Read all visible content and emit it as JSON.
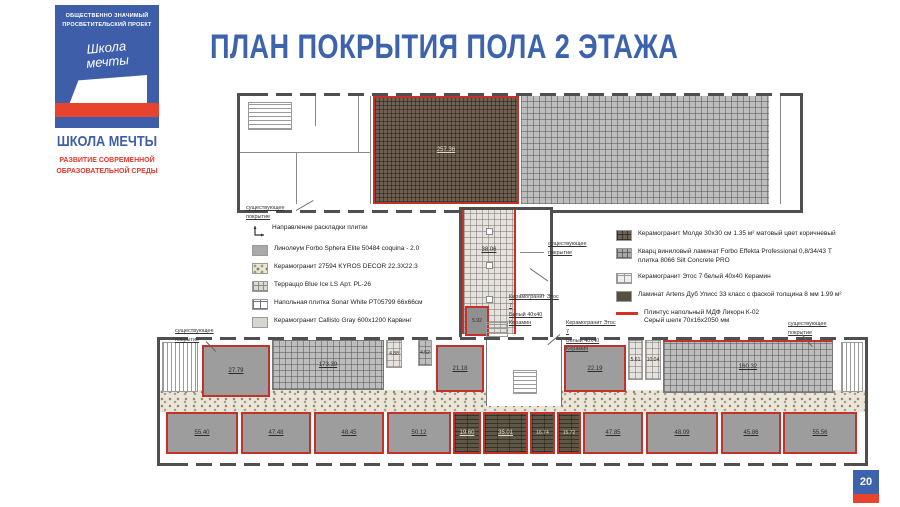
{
  "colors": {
    "brand_blue": "#3d63ad",
    "brand_red": "#e0392d",
    "plan_red": "#c53029"
  },
  "page": {
    "number": "20"
  },
  "logo": {
    "project_line1": "ОБЩЕСТВЕННО ЗНАЧИМЫЙ",
    "project_line2": "ПРОСВЕТИТЕЛЬСКИЙ ПРОЕКТ",
    "script_line1": "Школа",
    "script_line2": "мечты",
    "name": "ШКОЛА МЕЧТЫ",
    "tagline_line1": "РАЗВИТИЕ СОВРЕМЕННОЙ",
    "tagline_line2": "ОБРАЗОВАТЕЛЬНОЙ СРЕДЫ"
  },
  "title": "ПЛАН ПОКРЫТИЯ ПОЛА 2 ЭТАЖА",
  "legend_left": {
    "items": [
      {
        "label": "Направление раскладки плитки"
      },
      {
        "label": "Линолеум Forbo Sphera Elite 50484 coquina - 2.0"
      },
      {
        "label": "Керамогранит 27594 KYROS DECOR 22.3X22.3"
      },
      {
        "label": "Терраццо Blue Ice LS Арт. PL-26"
      },
      {
        "label": "Напольная плитка Sonar White PT05799 66x66см"
      },
      {
        "label": "Керамогранит Callisto Gray 600x1200 Карвинг"
      }
    ]
  },
  "legend_right": {
    "items": [
      {
        "label": "Керамогранит Молде 30x30 см 1.35 м² матовый цвет коричневый"
      },
      {
        "label": "Кварц виниловый ламинат Forbo Effekta Professional 0,8/34/43 Т плитка 8066 Silt Concrete PRO"
      },
      {
        "label": "Керамогранит Этос 7 белый 40x40 Керамин"
      },
      {
        "label": "Ламинат Artens Дуб Улисс 33 класс с фаской толщина 8 мм 1.99 м²"
      }
    ],
    "plinth_line1": "Плинтус напольный МДФ Ликорн К-02",
    "plinth_line2": "Серый шелк 70x16x2050 мм"
  },
  "plan": {
    "existing_line1": "существующее",
    "existing_line2": "покрытие",
    "tile_note_line1": "Керамогранит Этос 7",
    "tile_note_line2": "Белый 40x40 Керамин",
    "upper": {
      "hall_area": "257.36"
    },
    "connector": {
      "corridor_area": "38.06",
      "room_area": "5.92"
    },
    "lower": {
      "room_1": "27.79",
      "corridor_top": "173.39",
      "small_a": "4.88",
      "small_b": "4.52",
      "room_2": "21.18",
      "room_3": "22.19",
      "small_c": "5.61",
      "small_d": "10.04",
      "grid_right": "160.32",
      "corridor_mid": "34.02",
      "rooms_bottom": [
        "55.40",
        "47.48",
        "48.45",
        "50.12",
        "19.60",
        "35.01",
        "16.74",
        "15.72",
        "47.85",
        "48.09",
        "45.86",
        "55.56"
      ]
    }
  }
}
